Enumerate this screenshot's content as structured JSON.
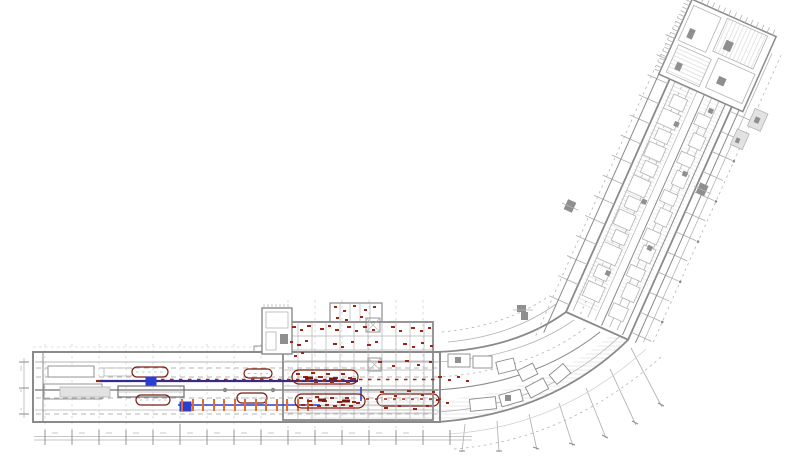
{
  "canvas": {
    "width": 799,
    "height": 457,
    "background": "#ffffff"
  },
  "colors": {
    "bg": "#ffffff",
    "line": "#8a8a8a",
    "line-light": "#b4b4b4",
    "line-faint": "#d2d2d2",
    "line-dark": "#6e6e6e",
    "fill-light": "#e2e2e2",
    "fill-mid": "#8f8f8f",
    "maroon": "#7b1b10",
    "red": "#9c2518",
    "navy": "#332b8c",
    "blue": "#2a3ed2",
    "orange": "#e26b2e"
  },
  "plan": {
    "regions": [
      {
        "name": "west-pier"
      },
      {
        "name": "central-terminal-block"
      },
      {
        "name": "curved-connector"
      },
      {
        "name": "northeast-pier"
      },
      {
        "name": "northeast-head-block"
      }
    ],
    "symbols": [
      {
        "name": "travelator-stadium",
        "color_key": "maroon",
        "count": 5
      },
      {
        "name": "redline-annotation-marks",
        "color_key": "red"
      },
      {
        "name": "utility-run-line",
        "color_key": "navy"
      },
      {
        "name": "selection-marker-square",
        "color_key": "blue",
        "count": 2
      },
      {
        "name": "spacing-tick-markers",
        "color_key": "orange",
        "count": 13
      },
      {
        "name": "dimension-strings",
        "color_key": "line"
      }
    ]
  }
}
